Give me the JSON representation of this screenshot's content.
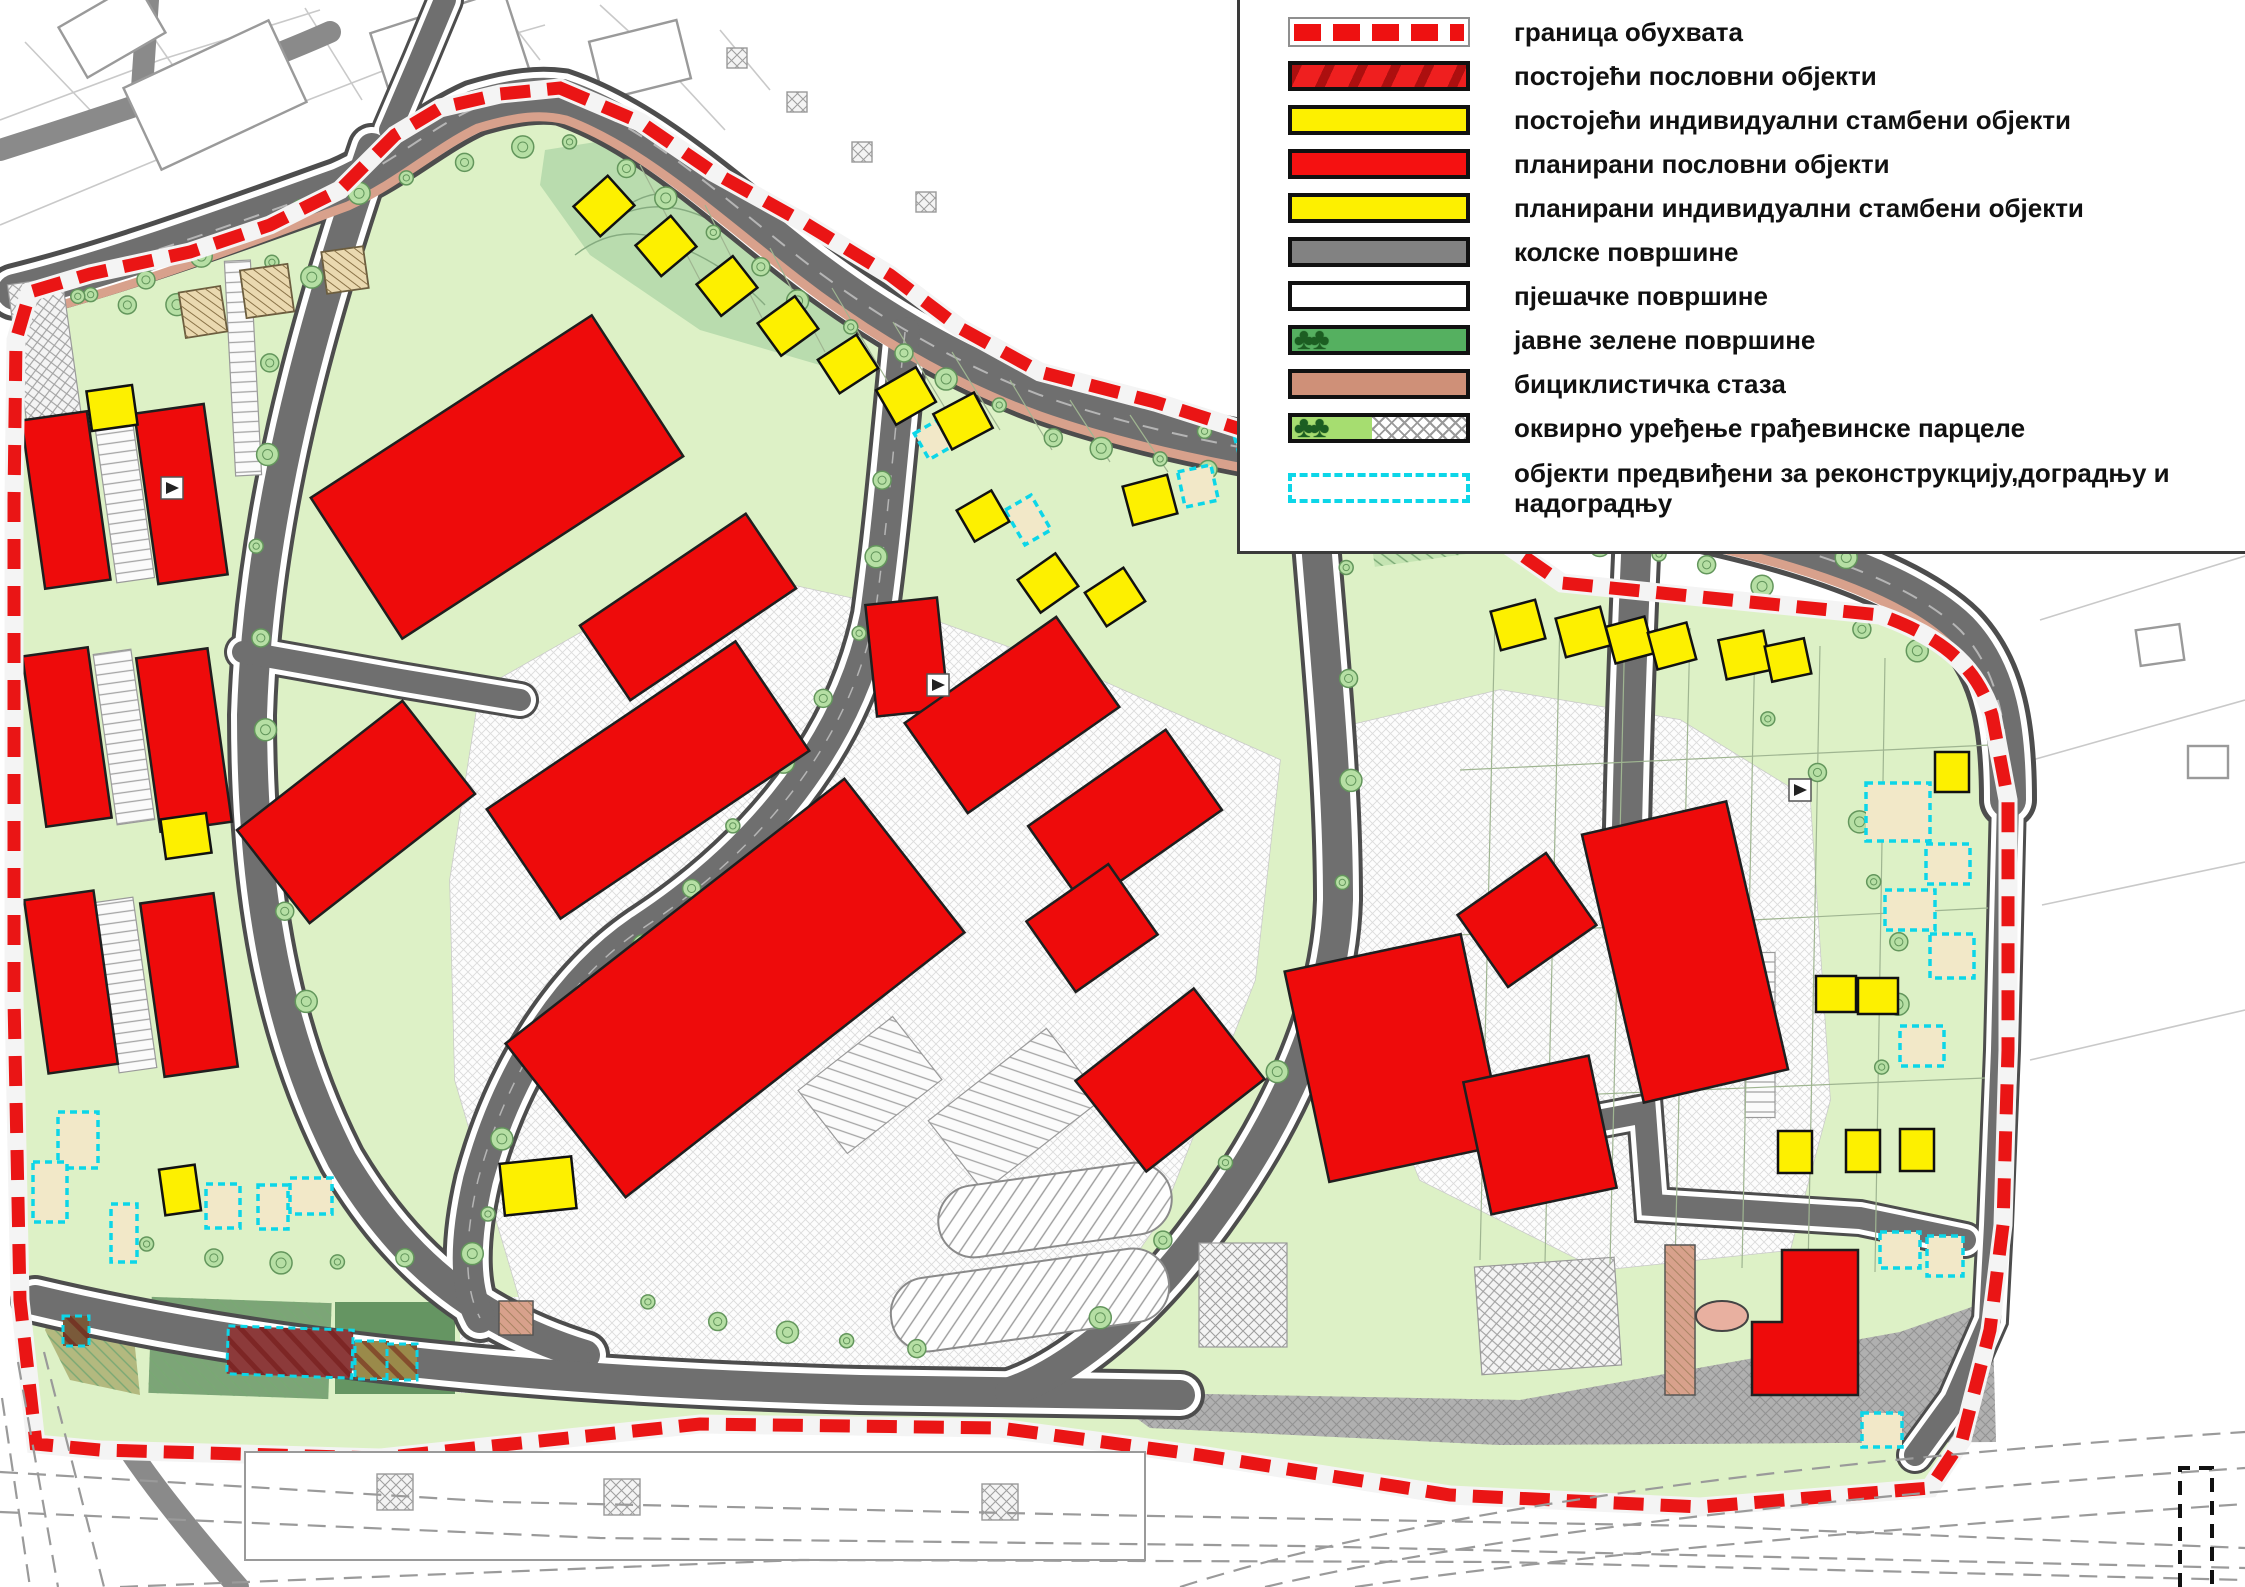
{
  "legend": {
    "items": [
      {
        "type": "boundary",
        "label": "граница обухвата"
      },
      {
        "type": "existing-business",
        "label": "постојећи пословни објекти"
      },
      {
        "type": "existing-residential",
        "label": "постојећи индивидуални стамбени објекти"
      },
      {
        "type": "planned-business",
        "label": "планирани пословни објекти"
      },
      {
        "type": "planned-residential",
        "label": "планирани индивидуални стамбени објекти"
      },
      {
        "type": "road",
        "label": "колске површине"
      },
      {
        "type": "pedestrian",
        "label": "пјешачке површине"
      },
      {
        "type": "public-green",
        "label": "јавне зелене површине"
      },
      {
        "type": "bike-path",
        "label": "бициклистичка стаза"
      },
      {
        "type": "parcel-arrangement",
        "label": "оквирно уређење грађевинске парцеле"
      },
      {
        "type": "reconstruction",
        "label": "објекти предвиђени за реконструкцију,доградњу и надоградњу"
      }
    ]
  },
  "palette": {
    "red": "#ee0b0b",
    "yellow": "#fdf000",
    "siteGreen": "#ddf1c6",
    "hillGreen": "#b9dcae",
    "roadGray": "#6f6f6f",
    "casing": "#4d4d4d",
    "sidewalk": "#ffffff",
    "bike": "#d8a18c",
    "cyan": "#0cd6e8",
    "beige": "#ead9b0",
    "beigeLight": "#f2e8c8",
    "boundary": "#ea1515",
    "grayArea": "#8b8b8b",
    "treeFill": "#b6dfa4",
    "treeStroke": "#63965c",
    "outsideLine": "#c9c9c9",
    "parkDark": "#74a273",
    "olive": "#b3b97f",
    "darkRedB": "#8c3a3a",
    "centerline": "#b5b5b5",
    "parcelLine": "#9fb591",
    "outlineBld": "#9a9a9a",
    "contour": "#86ab80"
  },
  "map": {
    "boundary": "M560,88 L640,122 L713,172 L803,222 L890,275 L960,328 L1040,372 L1155,402 L1300,448 L1450,505 L1562,583 L1750,602 L1880,615 C1950,640 1978,672 1992,715 L2008,800 L2008,1050 L2003,1225 L1990,1330 L1962,1440 L1930,1488 L1700,1507 L1450,1495 L1200,1455 L1000,1428 L700,1424 L380,1458 L100,1450 L36,1444 L20,1300 L14,1000 L14,500 L16,340 L30,292 L90,274 L190,252 L270,225 L340,190 L395,135 L440,108 L500,94 Z",
    "roads": [
      {
        "d": "M15,292 C120,266 250,218 340,186 C395,162 430,128 475,108 C515,96 540,94 562,97 C645,125 720,195 800,258 C880,320 960,365 1040,395 C1200,452 1390,470 1570,500 C1720,524 1890,562 1960,630 C2000,672 2008,730 2008,800",
        "k": "main"
      },
      {
        "d": "M372,148 C310,330 258,520 252,715 C252,895 278,1035 342,1160 C400,1258 472,1320 585,1355",
        "k": "std"
      },
      {
        "d": "M35,1300 C280,1358 560,1382 860,1390 C990,1393 1080,1393 1180,1395",
        "k": "std"
      },
      {
        "d": "M905,332 C895,430 888,520 875,615 C845,760 740,865 640,930 C560,985 505,1080 478,1180 C463,1245 465,1290 480,1318",
        "k": "std"
      },
      {
        "d": "M1310,465 C1320,610 1338,760 1338,900 C1335,1010 1280,1130 1195,1240 C1130,1325 1060,1375 1010,1392",
        "k": "std"
      },
      {
        "d": "M1638,512 C1632,640 1628,760 1626,880",
        "k": "std"
      },
      {
        "d": "M1560,1128 L1645,1112 L1652,1205 L1860,1218 L1965,1240",
        "k": "thin"
      },
      {
        "d": "M2008,800 L2002,1050 L1995,1225 L1990,1320 L1955,1400 L1915,1455",
        "k": "thin"
      },
      {
        "d": "M390,130 L420,60 L445,0",
        "k": "thin"
      },
      {
        "d": "M243,652 L400,680 L520,700",
        "k": "thin"
      }
    ],
    "bike": "M18,316 C130,290 255,240 348,206 C400,182 436,148 478,128 C518,116 542,114 566,120 C642,148 716,216 796,278 C876,340 958,386 1040,416 C1200,472 1392,490 1572,520 C1720,544 1884,580 1950,646",
    "paved": [
      "480,690 700,565 905,610 1100,680 1280,760 1255,980 1160,1220 1040,1390 640,1392 520,1300 455,1080 450,880",
      "1330,730 1500,690 1680,720 1810,800 1830,1100 1790,1250 1600,1270 1420,1180 1340,980"
    ],
    "grayArea": "1100,1392 1520,1400 1900,1332 1992,1300 1996,1442 1500,1445 1150,1428",
    "hill": "545,150 640,135 770,235 885,320 830,368 700,330 590,255 540,185",
    "contours": [
      "M575,255 q45,-35 95,-12 q55,20 95,62",
      "M598,228 q52,-38 112,-8",
      "M628,205 q32,-20 64,-6"
    ],
    "patches": [
      {
        "rect": [
          1475,
          525,
          210,
          55,
          -8
        ],
        "fill": "#c4e4b2",
        "hatch": "greenhatch"
      },
      {
        "poly": "60,1290 130,1300 140,1395 70,1380 45,1330",
        "fill": "#b3b97f",
        "hatch": "greenhatch"
      },
      {
        "rect": [
          240,
          1348,
          180,
          96,
          2
        ],
        "fill": "#7ca577",
        "hatch": "greenhatch"
      },
      {
        "rect": [
          395,
          1348,
          120,
          92,
          0
        ],
        "fill": "#659562"
      },
      {
        "rect": [
          510,
          1345,
          100,
          96,
          0
        ],
        "fill": "#d9ead0",
        "hatch": "crossP"
      }
    ],
    "parking": {
      "h": [
        [
          124,
          497,
          38,
          168,
          -8
        ],
        [
          124,
          737,
          38,
          172,
          -8
        ],
        [
          126,
          985,
          38,
          172,
          -8
        ],
        [
          243,
          368,
          26,
          215,
          -3
        ],
        [
          1760,
          1035,
          30,
          165,
          0
        ],
        [
          1888,
          498,
          120,
          56,
          -18
        ]
      ],
      "a": [
        [
          585,
          452,
          150,
          88,
          -33
        ],
        [
          1015,
          1110,
          150,
          90,
          -38
        ],
        [
          870,
          1085,
          120,
          80,
          -38
        ]
      ],
      "cross": [
        [
          50,
          390,
          55,
          220,
          -8
        ],
        [
          1243,
          1295,
          88,
          104,
          0
        ],
        [
          1548,
          1316,
          140,
          108,
          -4
        ]
      ],
      "stadium": [
        [
          1055,
          1210,
          235,
          72,
          -8
        ],
        [
          1030,
          1300,
          280,
          74,
          -8
        ]
      ]
    },
    "trees": [
      {
        "pts": [
          [
            70,
            310
          ],
          [
            300,
            208
          ],
          [
            555,
            140
          ],
          [
            640,
            170
          ],
          [
            800,
            300
          ],
          [
            1040,
            432
          ],
          [
            1400,
            508
          ],
          [
            1700,
            560
          ],
          [
            1940,
            665
          ]
        ],
        "n": 36
      },
      {
        "pts": [
          [
            1180,
            432
          ],
          [
            1450,
            462
          ],
          [
            1700,
            515
          ],
          [
            1880,
            562
          ]
        ],
        "n": 12
      },
      {
        "pts": [
          [
            898,
            360
          ],
          [
            862,
            640
          ],
          [
            700,
            880
          ],
          [
            520,
            1080
          ],
          [
            480,
            1250
          ]
        ],
        "n": 13
      },
      {
        "pts": [
          [
            1352,
            520
          ],
          [
            1346,
            900
          ],
          [
            1240,
            1150
          ],
          [
            1062,
            1360
          ]
        ],
        "n": 9
      },
      {
        "pts": [
          [
            280,
            220
          ],
          [
            260,
            520
          ],
          [
            262,
            800
          ],
          [
            310,
            1050
          ]
        ],
        "n": 9
      },
      {
        "pts": [
          [
            120,
            1245
          ],
          [
            300,
            1262
          ],
          [
            500,
            1252
          ]
        ],
        "n": 6
      },
      {
        "pts": [
          [
            1750,
            700
          ],
          [
            1850,
            800
          ],
          [
            1902,
            950
          ],
          [
            1880,
            1100
          ]
        ],
        "n": 7
      },
      {
        "pts": [
          [
            620,
            1300
          ],
          [
            800,
            1332
          ],
          [
            950,
            1352
          ]
        ],
        "n": 5
      },
      {
        "pts": [
          [
            60,
            300
          ],
          [
            200,
            302
          ],
          [
            330,
            272
          ]
        ],
        "n": 6
      }
    ],
    "plines": [
      "M1495,615 L1480,1260",
      "M1560,618 L1545,1262",
      "M1625,622 L1610,1264",
      "M1690,628 L1675,1266",
      "M1755,636 L1742,1268",
      "M1820,646 L1808,1270",
      "M1885,658 L1875,1272",
      "M1460,770 L1990,745",
      "M1458,935 L1988,908",
      "M1455,1100 L1985,1078",
      "M640,165 L700,280",
      "M705,205 L762,318",
      "M770,248 L825,352",
      "M832,288 L888,382",
      "M893,322 L945,408",
      "M952,352 L1000,430",
      "M1010,380 L1052,450",
      "M1070,400 L1110,462",
      "M1130,415 L1168,472"
    ],
    "buildings": {
      "pb": [
        [
          66,
          500,
          66,
          170,
          -8
        ],
        [
          181,
          494,
          70,
          172,
          -8
        ],
        [
          67,
          737,
          66,
          172,
          -8
        ],
        [
          184,
          740,
          72,
          175,
          -8
        ],
        [
          71,
          982,
          70,
          175,
          -8
        ],
        [
          189,
          985,
          74,
          175,
          -8
        ],
        [
          356,
          812,
          210,
          118,
          -38
        ],
        [
          497,
          477,
          335,
          168,
          -33
        ],
        [
          688,
          607,
          200,
          90,
          -34
        ],
        [
          648,
          780,
          300,
          132,
          -34
        ],
        [
          735,
          988,
          430,
          195,
          -38
        ],
        [
          907,
          657,
          72,
          112,
          -6
        ],
        [
          1012,
          715,
          185,
          110,
          -35
        ],
        [
          1125,
          818,
          168,
          98,
          -35
        ],
        [
          1092,
          928,
          100,
          86,
          -35
        ],
        [
          1170,
          1080,
          150,
          115,
          -38
        ],
        [
          1527,
          920,
          108,
          88,
          -35
        ],
        [
          1395,
          1058,
          180,
          215,
          -12
        ],
        [
          1540,
          1135,
          128,
          135,
          -12
        ],
        [
          1685,
          952,
          148,
          275,
          -13
        ]
      ],
      "lshape": "1782,1250 1858,1250 1858,1395 1752,1395 1752,1322 1782,1322",
      "pr": [
        [
          112,
          408,
          -8
        ],
        [
          186,
          836,
          -8
        ],
        [
          180,
          1190,
          -8,
          36,
          46
        ],
        [
          538,
          1186,
          -6,
          72,
          52
        ],
        [
          604,
          206,
          -42
        ],
        [
          666,
          246,
          -40
        ],
        [
          727,
          286,
          -38
        ],
        [
          788,
          326,
          -36
        ],
        [
          848,
          364,
          -33
        ],
        [
          906,
          396,
          -30
        ],
        [
          963,
          421,
          -28
        ],
        [
          983,
          516,
          -30,
          40,
          36
        ],
        [
          1048,
          583,
          -35
        ],
        [
          1115,
          597,
          -33
        ],
        [
          1150,
          500,
          -15
        ],
        [
          1518,
          625,
          -15
        ],
        [
          1583,
          632,
          -15
        ],
        [
          1630,
          640,
          -15,
          40,
          38
        ],
        [
          1672,
          646,
          -15,
          40,
          38
        ],
        [
          1745,
          655,
          -12
        ],
        [
          1788,
          660,
          -12,
          40,
          36
        ],
        [
          1952,
          772,
          0,
          34,
          40
        ],
        [
          1836,
          994,
          0,
          40,
          36
        ],
        [
          1878,
          996,
          0,
          40,
          36
        ],
        [
          1795,
          1152,
          0,
          34,
          42
        ],
        [
          1863,
          1151,
          0,
          34,
          42
        ],
        [
          1917,
          1150,
          0,
          34,
          42
        ]
      ],
      "er": [
        [
          203,
          312,
          -9,
          42,
          46
        ],
        [
          267,
          291,
          -8,
          48,
          48
        ],
        [
          345,
          270,
          -8,
          42,
          42
        ]
      ],
      "rec": [
        [
          78,
          1140,
          0,
          40,
          56
        ],
        [
          50,
          1192,
          0,
          34,
          60
        ],
        [
          124,
          1233,
          0,
          26,
          58
        ],
        [
          223,
          1206,
          0,
          34,
          44
        ],
        [
          273,
          1207,
          0,
          30,
          44
        ],
        [
          311,
          1196,
          0,
          42,
          36
        ],
        [
          1028,
          520,
          -30,
          30,
          40
        ],
        [
          933,
          440,
          -30,
          26,
          30
        ],
        [
          1198,
          486,
          -12,
          34,
          36
        ],
        [
          1253,
          448,
          -15,
          30,
          34
        ],
        [
          1372,
          458,
          -12,
          30,
          34
        ],
        [
          1455,
          463,
          -10,
          30,
          34
        ],
        [
          1898,
          812,
          0,
          64,
          58
        ],
        [
          1948,
          864,
          0,
          44,
          40
        ],
        [
          1910,
          910,
          0,
          50,
          40
        ],
        [
          1952,
          956,
          0,
          44,
          44
        ],
        [
          1922,
          1046,
          0,
          44,
          40
        ],
        [
          1900,
          1250,
          0,
          40,
          36
        ],
        [
          1945,
          1256,
          0,
          36,
          40
        ],
        [
          1882,
          1430,
          0,
          40,
          34
        ]
      ],
      "eb": [
        [
          290,
          1352,
          125,
          48,
          2,
          "#8c3a3a"
        ],
        [
          76,
          1331,
          26,
          30,
          0,
          "#7a5a3a"
        ],
        [
          372,
          1360,
          34,
          38,
          0,
          "#9a8a4a"
        ],
        [
          402,
          1362,
          30,
          36,
          0,
          "#9a8a4a"
        ]
      ],
      "salmon": [
        [
          1680,
          1320,
          30,
          150,
          0
        ],
        [
          516,
          1318,
          34,
          34,
          0
        ]
      ],
      "oval": [
        1722,
        1316,
        26,
        15
      ]
    },
    "markers": [
      [
        172,
        488
      ],
      [
        938,
        685
      ],
      [
        1800,
        790
      ]
    ],
    "outside": {
      "lines": [
        "M0,120 L160,60 L320,10",
        "M0,225 L200,142 L380,72 L545,25",
        "M60,305 L240,215 L420,132",
        "M140,18 L212,122",
        "M305,8 L362,100",
        "M432,28 L478,96",
        "M25,42 L92,112",
        "M500,8 L540,60",
        "M600,5 L660,60 L725,130",
        "M720,30 L770,90",
        "M2040,620 L2245,556",
        "M2025,762 L2245,700",
        "M2042,905 L2245,862",
        "M2030,1060 L2245,1010"
      ],
      "roads": [
        "M0,150 C120,112 240,72 330,32",
        "M148,0 L142,88",
        "M85,1378 C130,1460 180,1520 238,1587"
      ],
      "buildings": [
        [
          215,
          95,
          160,
          90,
          -25
        ],
        [
          450,
          52,
          140,
          85,
          -18
        ],
        [
          112,
          30,
          90,
          58,
          -30
        ],
        [
          640,
          60,
          90,
          60,
          -14
        ],
        [
          2160,
          645,
          44,
          36,
          -8
        ],
        [
          2208,
          762,
          40,
          32,
          0
        ]
      ],
      "squares": [
        [
          737,
          58
        ],
        [
          797,
          102
        ],
        [
          862,
          152
        ],
        [
          926,
          202
        ]
      ],
      "hall": {
        "rect": [
          695,
          1506,
          900,
          108
        ],
        "squares": [
          [
            395,
            1492
          ],
          [
            622,
            1497
          ],
          [
            1000,
            1502
          ]
        ]
      },
      "railway": [
        "M0,1472 L500,1502 L1100,1515 L1700,1526 L2245,1548",
        "M0,1512 L600,1538 L1300,1546 L2245,1568",
        "M120,1587 L800,1560 L1500,1562 L2245,1580",
        "M1180,1587 Q1520,1478 2245,1432",
        "M1265,1587 Q1585,1512 2245,1468",
        "M1355,1587 Q1640,1545 2245,1504",
        "M18,1362 L58,1587",
        "M44,1352 L104,1587",
        "M2,1398 L30,1587"
      ],
      "blackdash": "M2180,1587 L2180,1468 L2212,1468 L2212,1587"
    }
  }
}
